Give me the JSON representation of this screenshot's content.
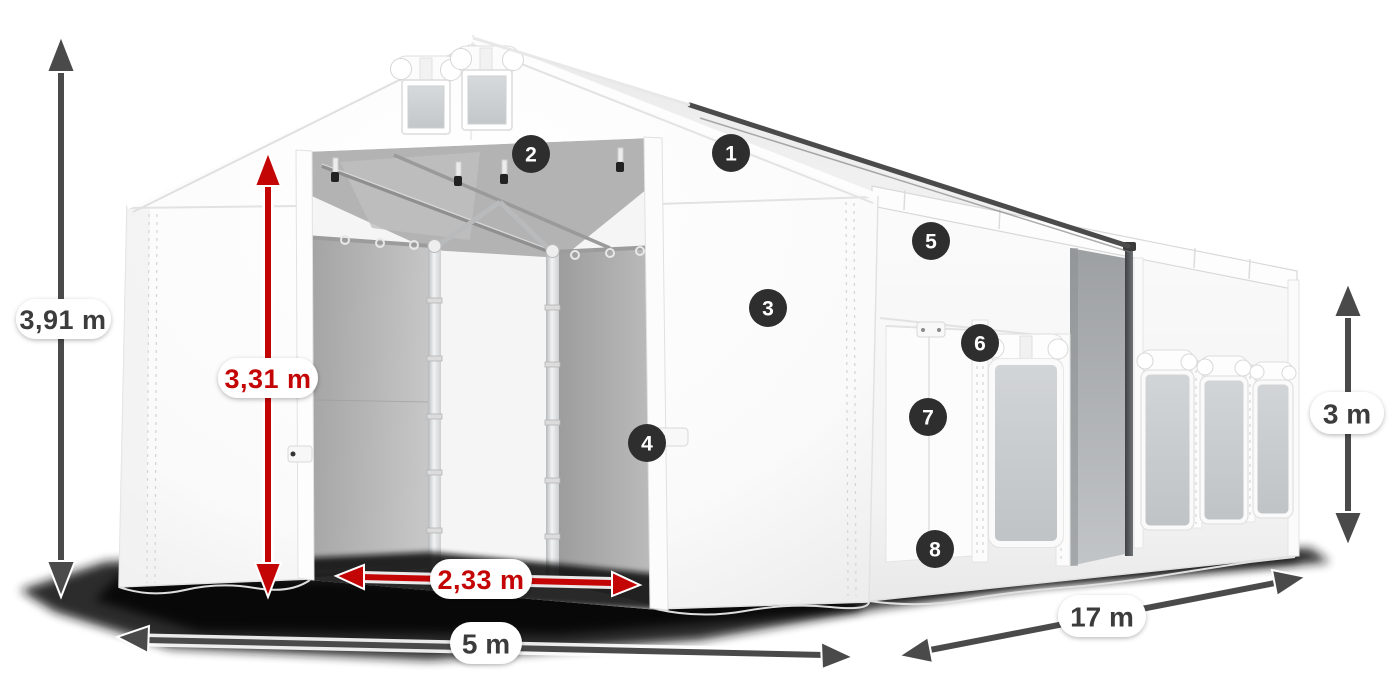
{
  "colors": {
    "accent_red": "#c40505",
    "arrow_dark": "#4a4a4a",
    "badge_bg": "#2e2e2e",
    "label_text_dark": "#3c3c3c"
  },
  "dimensions": {
    "total_height": {
      "value": "3,91 m"
    },
    "entrance_height": {
      "value": "3,31 m"
    },
    "entrance_width": {
      "value": "2,33 m"
    },
    "width": {
      "value": "5 m"
    },
    "length": {
      "value": "17 m"
    },
    "side_height": {
      "value": "3 m"
    }
  },
  "badges": [
    {
      "number": "1"
    },
    {
      "number": "2"
    },
    {
      "number": "3"
    },
    {
      "number": "4"
    },
    {
      "number": "5"
    },
    {
      "number": "6"
    },
    {
      "number": "7"
    },
    {
      "number": "8"
    }
  ]
}
